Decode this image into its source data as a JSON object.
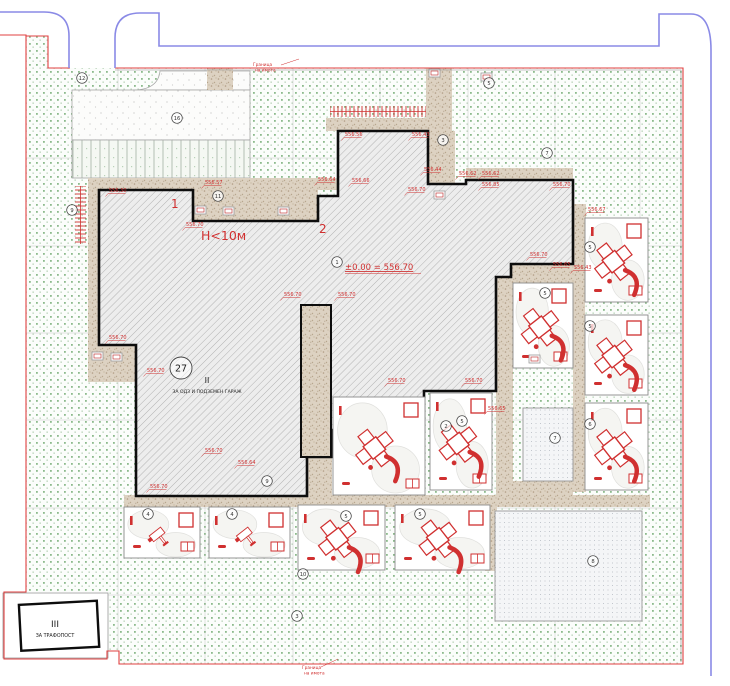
{
  "plan": {
    "zone1_label": "1",
    "zone2_label": "2",
    "height_note": "Н<10м",
    "level_mark": "±0.00 = 556.70",
    "building2_num": "II",
    "building2_label": "ЗА ОДЗ И ПОДЗЕМЕН ГАРАЖ",
    "building3_num": "III",
    "building3_label": "ЗА ТРАФОПОСТ",
    "big_circle_num": "27",
    "boundary_label_line1": "Граница",
    "boundary_label_line2": "на имота"
  },
  "colors": {
    "red_accent": "#d03030",
    "grass_green": "#86b886",
    "road_blue": "#8888e8",
    "walkway_tan": "#ddd2c4",
    "building_outline": "#0d0d0d"
  },
  "elevation_labels": [
    {
      "x": 109,
      "y": 192,
      "v": "556.30"
    },
    {
      "x": 186,
      "y": 226,
      "v": "556.70"
    },
    {
      "x": 205,
      "y": 184,
      "v": "556.57"
    },
    {
      "x": 109,
      "y": 339,
      "v": "556.70"
    },
    {
      "x": 345,
      "y": 136,
      "v": "556.56"
    },
    {
      "x": 412,
      "y": 136,
      "v": "556.43"
    },
    {
      "x": 318,
      "y": 181,
      "v": "556.64"
    },
    {
      "x": 352,
      "y": 182,
      "v": "556.66"
    },
    {
      "x": 408,
      "y": 191,
      "v": "556.70"
    },
    {
      "x": 424,
      "y": 171,
      "v": "556.44"
    },
    {
      "x": 459,
      "y": 175,
      "v": "556.62"
    },
    {
      "x": 482,
      "y": 175,
      "v": "556.62"
    },
    {
      "x": 482,
      "y": 186,
      "v": "556.85"
    },
    {
      "x": 553,
      "y": 186,
      "v": "556.70"
    },
    {
      "x": 284,
      "y": 296,
      "v": "556.70"
    },
    {
      "x": 338,
      "y": 296,
      "v": "556.70"
    },
    {
      "x": 147,
      "y": 372,
      "v": "556.70"
    },
    {
      "x": 205,
      "y": 452,
      "v": "556.70"
    },
    {
      "x": 238,
      "y": 464,
      "v": "556.64"
    },
    {
      "x": 150,
      "y": 488,
      "v": "556.70"
    },
    {
      "x": 388,
      "y": 382,
      "v": "556.70"
    },
    {
      "x": 465,
      "y": 382,
      "v": "556.70"
    },
    {
      "x": 488,
      "y": 410,
      "v": "556.65"
    },
    {
      "x": 530,
      "y": 256,
      "v": "556.70"
    },
    {
      "x": 553,
      "y": 266,
      "v": "556.65"
    },
    {
      "x": 588,
      "y": 211,
      "v": "556.67"
    },
    {
      "x": 574,
      "y": 269,
      "v": "556.43"
    }
  ],
  "circled_numbers": [
    {
      "x": 82,
      "y": 78,
      "n": "12"
    },
    {
      "x": 177,
      "y": 118,
      "n": "16"
    },
    {
      "x": 72,
      "y": 210,
      "n": "9"
    },
    {
      "x": 218,
      "y": 196,
      "n": "11"
    },
    {
      "x": 337,
      "y": 262,
      "n": "1"
    },
    {
      "x": 443,
      "y": 140,
      "n": "3"
    },
    {
      "x": 489,
      "y": 83,
      "n": "5"
    },
    {
      "x": 547,
      "y": 153,
      "n": "7"
    },
    {
      "x": 555,
      "y": 438,
      "n": "7"
    },
    {
      "x": 593,
      "y": 561,
      "n": "8"
    },
    {
      "x": 267,
      "y": 481,
      "n": "9"
    },
    {
      "x": 446,
      "y": 426,
      "n": "2"
    },
    {
      "x": 462,
      "y": 421,
      "n": "5"
    },
    {
      "x": 545,
      "y": 293,
      "n": "5"
    },
    {
      "x": 590,
      "y": 247,
      "n": "5"
    },
    {
      "x": 590,
      "y": 326,
      "n": "5"
    },
    {
      "x": 590,
      "y": 424,
      "n": "6"
    },
    {
      "x": 148,
      "y": 514,
      "n": "4"
    },
    {
      "x": 232,
      "y": 514,
      "n": "4"
    },
    {
      "x": 346,
      "y": 516,
      "n": "5"
    },
    {
      "x": 420,
      "y": 514,
      "n": "5"
    },
    {
      "x": 297,
      "y": 616,
      "n": "3"
    },
    {
      "x": 303,
      "y": 574,
      "n": "10"
    }
  ],
  "playground_cells": [
    {
      "x": 124,
      "y": 507,
      "w": 76,
      "h": 51,
      "t": "spring"
    },
    {
      "x": 209,
      "y": 507,
      "w": 81,
      "h": 51,
      "t": "spring"
    },
    {
      "x": 298,
      "y": 505,
      "w": 87,
      "h": 65,
      "t": "climber"
    },
    {
      "x": 395,
      "y": 505,
      "w": 95,
      "h": 65,
      "t": "climber"
    },
    {
      "x": 333,
      "y": 397,
      "w": 92,
      "h": 98,
      "t": "climber"
    },
    {
      "x": 430,
      "y": 393,
      "w": 62,
      "h": 97,
      "t": "climber"
    },
    {
      "x": 513,
      "y": 283,
      "w": 60,
      "h": 85,
      "t": "climber"
    },
    {
      "x": 585,
      "y": 218,
      "w": 63,
      "h": 84,
      "t": "climber"
    },
    {
      "x": 585,
      "y": 315,
      "w": 63,
      "h": 80,
      "t": "climber"
    },
    {
      "x": 585,
      "y": 403,
      "w": 63,
      "h": 87,
      "t": "climber"
    }
  ],
  "benches": [
    {
      "x": 195,
      "y": 206
    },
    {
      "x": 223,
      "y": 207
    },
    {
      "x": 278,
      "y": 207
    },
    {
      "x": 434,
      "y": 191
    },
    {
      "x": 92,
      "y": 352
    },
    {
      "x": 111,
      "y": 353
    },
    {
      "x": 481,
      "y": 73
    },
    {
      "x": 429,
      "y": 69
    },
    {
      "x": 529,
      "y": 355
    }
  ]
}
